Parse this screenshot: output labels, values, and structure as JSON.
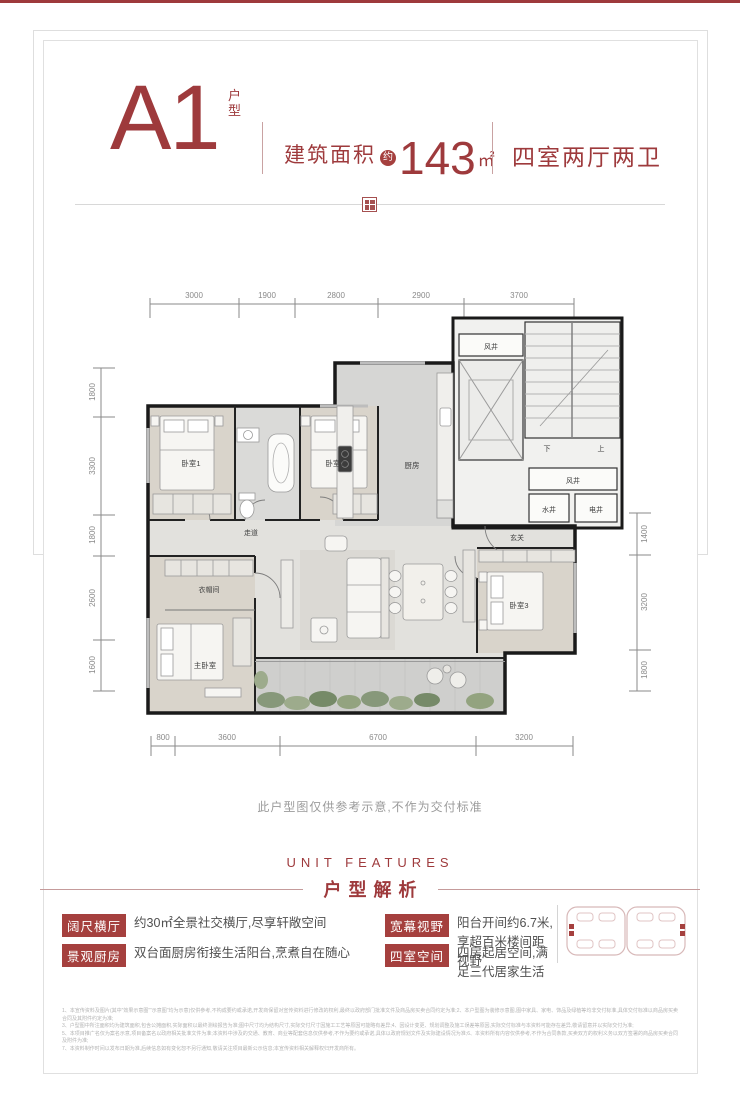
{
  "header": {
    "unit_code": "A1",
    "unit_suffix_1": "户",
    "unit_suffix_2": "型",
    "area_label": "建筑面积",
    "area_approx": "约",
    "area_value": "143",
    "area_unit": "㎡",
    "layout": "四室两厅两卫"
  },
  "plan": {
    "dims_top": [
      "3000",
      "1900",
      "2800",
      "2900",
      "3700"
    ],
    "dims_left": [
      "1800",
      "3300",
      "1800",
      "2600",
      "1600"
    ],
    "dims_right": [
      "1400",
      "3200",
      "1800"
    ],
    "dims_bottom": [
      "800",
      "3600",
      "6700",
      "3200"
    ],
    "rooms": {
      "bedroom1": "卧室1",
      "bedroom2": "卧室2",
      "bedroom3": "卧室3",
      "master_bedroom": "主卧室",
      "cloakroom": "衣帽间",
      "kitchen": "厨房",
      "corridor": "走道",
      "foyer": "玄关",
      "wind_shaft": "风井",
      "water_shaft": "水井",
      "electric_shaft": "电井",
      "stairs_down": "下",
      "stairs_up": "上"
    }
  },
  "note": "此户型图仅供参考示意,不作为交付标准",
  "features_section": {
    "title_en": "UNIT FEATURES",
    "title_cn": "户型解析",
    "items": [
      {
        "tag": "阔尺横厅",
        "desc": "约30㎡全景社交横厅,尽享轩敞空间"
      },
      {
        "tag": "景观厨房",
        "desc": "双台面厨房衔接生活阳台,烹煮自在随心"
      },
      {
        "tag": "宽幕视野",
        "desc": "阳台开间约6.7米,享超百米楼间距视野"
      },
      {
        "tag": "四室空间",
        "desc": "四房起居空间,满足三代居家生活"
      }
    ]
  },
  "disclaimer_lines": [
    "1、本宣传资料及图片(其中“效果示意图”“示意图”均为示意)仅供参考,不构成要约或承诺,开发商保留对宣传资料进行修改的权利,最终以政府部门批准文件及商品房买卖合同约定为准;2、本户型图为装修示意图,图中家具、家电、饰品及绿植等均非交付标准,具体交付标准以商品房买卖合同及其附件约定为准;",
    "3、户型图中所注面积均为建筑面积,包含公摊面积,实际面积以最终测绘报告为准;图中尺寸均为结构尺寸,实际交付尺寸因施工工艺等原因可能略有差异;4、因设计变更、规划调整及施工误差等原因,实际交付标准与本资料可能存在差异,敬请留意并以实际交付为准;",
    "5、本项目推广名仅为案名示意,项目备案名以政府相关批准文件为准;本资料中涉及的交通、教育、商业等配套信息仅供参考,不作为要约或承诺,具体以政府规划文件及实际建设情况为准;6、本资料所有内容仅供参考,不作为合同条款,买卖双方的权利义务以双方签署的商品房买卖合同及附件为准;",
    "7、本资料制作时间以发布日期为准,后续信息如有变化恕不另行通知,敬请关注项目最新公示信息;本宣传资料相关解释权归开发商所有。"
  ],
  "colors": {
    "accent": "#9E3A3C",
    "badge_bg": "#A5403E",
    "wall": "#1A1A1A"
  }
}
